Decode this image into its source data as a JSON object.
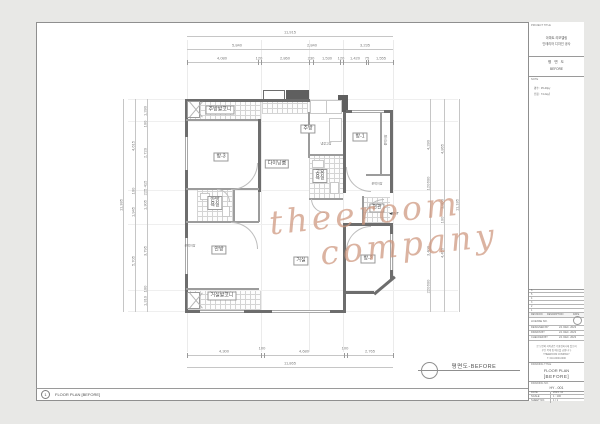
{
  "colors": {
    "background": "#e8e8e6",
    "wall": "#6d6d6d",
    "dim_text": "#7d7d7d",
    "watermark": "#cd967d",
    "sheet_border": "#8f8f8f"
  },
  "watermark": {
    "line1": "theeroom",
    "line2": "company"
  },
  "plan": {
    "caption": "평면도-BEFORE",
    "rooms": {
      "kitchen_balcony": "주방발코니",
      "room3": "방-3",
      "dining": "다이닝룸",
      "kitchen": "주방",
      "room1": "방-1",
      "master_bath_l1": "안방",
      "master_bath_l2": "욕실",
      "common_bath_l1": "공용",
      "common_bath_l2": "욕실",
      "master": "안방",
      "living": "거실",
      "room2": "방-2",
      "living_balcony": "거실발코니",
      "entrance": "현관"
    },
    "small_labels": {
      "closet1": "붙박이장",
      "closet2": "붙박이장",
      "closet3": "붙박이장",
      "fridge": "냉장고장",
      "ent": "◀ENT"
    }
  },
  "dimensions": {
    "top": {
      "r1": [
        "11,915"
      ],
      "r2": [
        "5,840",
        "2,840",
        "3,235"
      ],
      "r3": [
        "4,080",
        "120",
        "2,860",
        "230",
        "1,530",
        "120",
        "1,420",
        "75",
        "1,555"
      ]
    },
    "bottom": {
      "r1": [
        "4,300",
        "100",
        "4,680",
        "100",
        "2,765"
      ],
      "r2": [
        "11,865"
      ]
    },
    "left": {
      "outer": "11,385",
      "mid": [
        "4,615",
        "100",
        "1,945",
        "5,705"
      ],
      "inner": [
        "1,280",
        "100",
        "2,720",
        "415",
        "225",
        "1,305",
        "3,795",
        "100",
        "1,310"
      ]
    },
    "right": {
      "outer": "11,185",
      "mid": [
        "4,865",
        "1,800",
        "100",
        "4,450"
      ],
      "inner": [
        "4,280",
        "600",
        "120",
        "3,400",
        "600",
        "220"
      ]
    }
  },
  "title_block": {
    "project_title_label": "PROJECT TITLE",
    "project_line1": "아파트 리모델링",
    "project_line2": "인테리어 디자인 공사",
    "stage_line1": "평 면 도",
    "stage_line2": "BEFORE",
    "note_label": "NOTE",
    "note_line1": "평수 : 35-40py",
    "note_line2": "전용 : 74.22㎡",
    "rev_numbers": [
      "6",
      "5",
      "4",
      "3",
      "2",
      "1"
    ],
    "rev_header_1": "REVISION",
    "rev_header_2": "DESCRIPTION",
    "rev_header_3": "DATE",
    "license_label": "LICENSE NO.",
    "credits": [
      {
        "role": "DESIGNED BY",
        "date": "24. DEC. 2023"
      },
      {
        "role": "DRAWN BY",
        "date": "24. DEC. 2023"
      },
      {
        "role": "CHECKED BY",
        "date": "24. DEC. 2023"
      }
    ],
    "notice_line1": "본 도면의 저작권은 더룸컴퍼니에 있으며",
    "notice_line2": "무단 복제 및 배포를 금합니다.",
    "notice_center1": "THEEROOM COMPANY",
    "notice_center2": "T. 010-0000-0000",
    "drawing_title_label": "DRAWING TITLE",
    "drawing_title1": "FLOOR PLAN",
    "drawing_title2": "[BEFORE]",
    "drawing_no_label": "DRAWING NO.",
    "drawing_no": "HY - 001",
    "meta": [
      {
        "k": "DATE",
        "v": "2023. 12"
      },
      {
        "k": "SCALE",
        "v": "1 : 100"
      },
      {
        "k": "SHEET NO.",
        "v": "1 / 1"
      }
    ]
  },
  "footer": {
    "number": "1",
    "label": "FLOOR PLAN  [BEFORE]"
  }
}
